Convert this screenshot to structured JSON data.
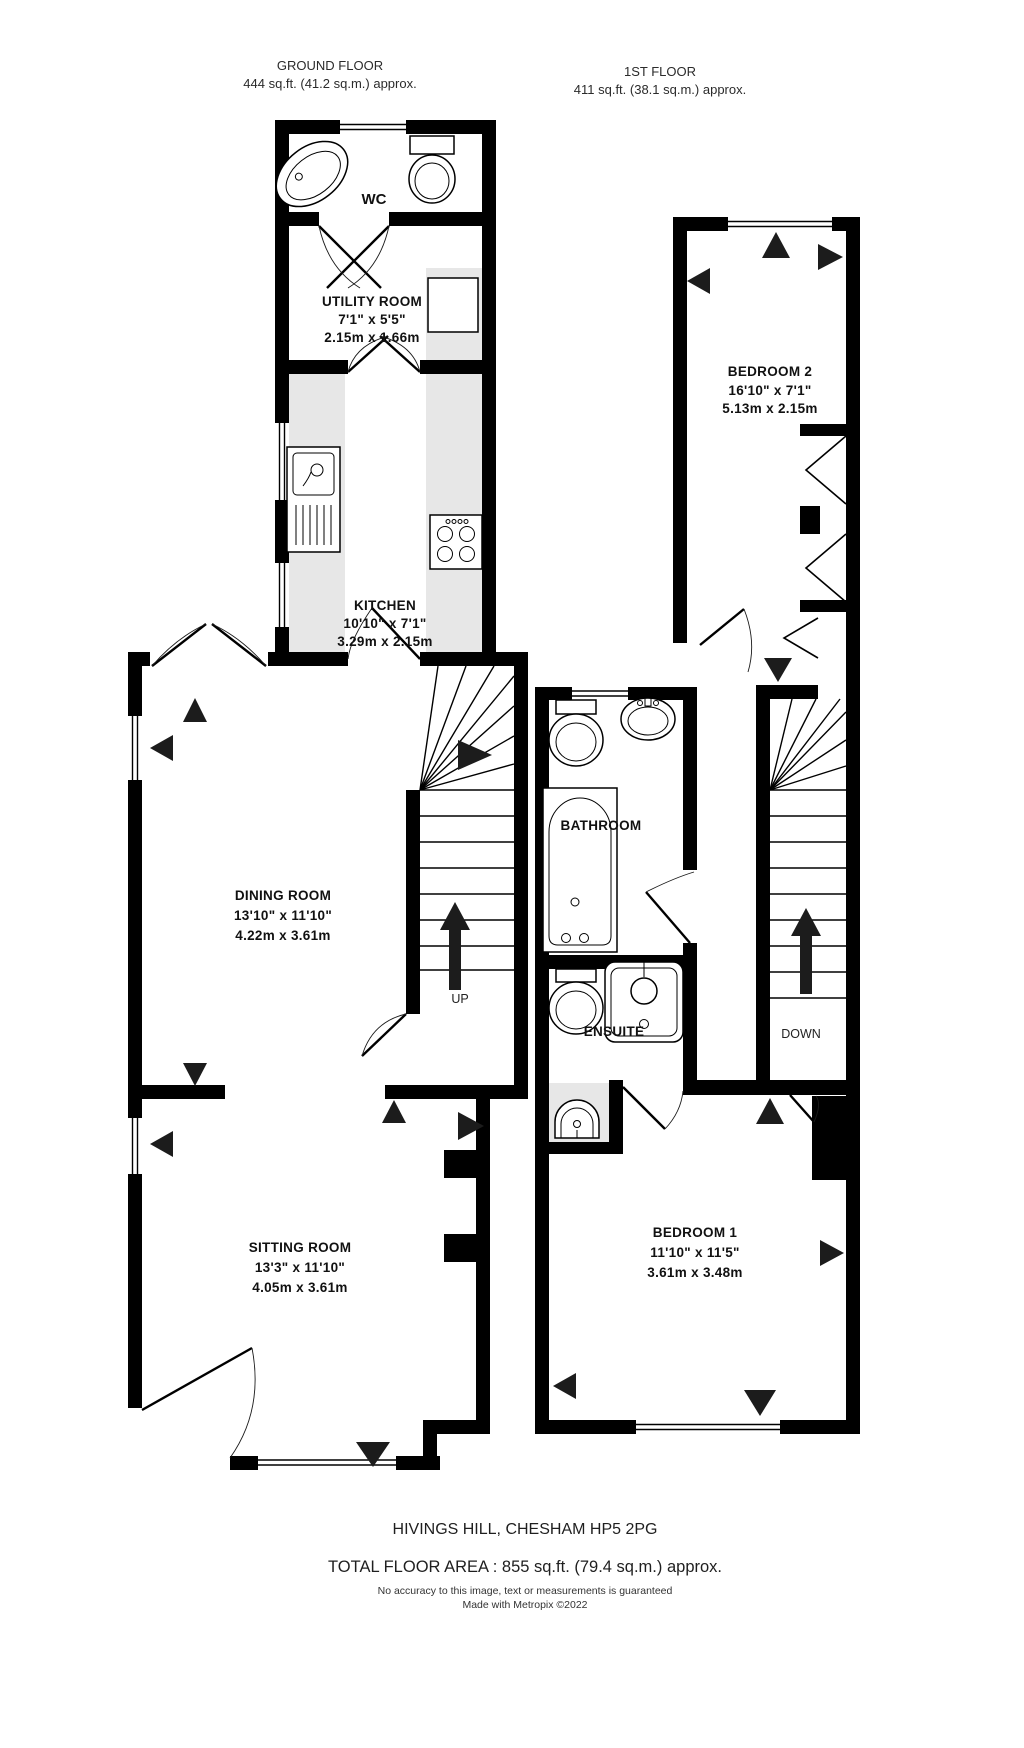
{
  "floors": {
    "ground": {
      "title": "GROUND FLOOR",
      "area": "444 sq.ft. (41.2 sq.m.) approx."
    },
    "first": {
      "title": "1ST FLOOR",
      "area": "411 sq.ft. (38.1 sq.m.) approx."
    }
  },
  "rooms": {
    "wc": {
      "name": "WC"
    },
    "utility": {
      "name": "UTILITY ROOM",
      "size_imperial": "7'1\" x 5'5\"",
      "size_metric": "2.15m x 1.66m"
    },
    "kitchen": {
      "name": "KITCHEN",
      "size_imperial": "10'10\" x 7'1\"",
      "size_metric": "3.29m x 2.15m"
    },
    "dining": {
      "name": "DINING ROOM",
      "size_imperial": "13'10\" x 11'10\"",
      "size_metric": "4.22m x 3.61m"
    },
    "sitting": {
      "name": "SITTING ROOM",
      "size_imperial": "13'3\" x 11'10\"",
      "size_metric": "4.05m x 3.61m"
    },
    "bedroom2": {
      "name": "BEDROOM 2",
      "size_imperial": "16'10\" x 7'1\"",
      "size_metric": "5.13m x 2.15m"
    },
    "bathroom": {
      "name": "BATHROOM"
    },
    "ensuite": {
      "name": "ENSUITE"
    },
    "bedroom1": {
      "name": "BEDROOM 1",
      "size_imperial": "11'10\" x 11'5\"",
      "size_metric": "3.61m x 3.48m"
    }
  },
  "stairs": {
    "up": "UP",
    "down": "DOWN"
  },
  "footer": {
    "address": "HIVINGS HILL, CHESHAM HP5 2PG",
    "total_area": "TOTAL FLOOR AREA : 855 sq.ft. (79.4 sq.m.) approx.",
    "disclaimer": "No accuracy to this image, text or measurements is guaranteed",
    "credit": "Made with Metropix ©2022"
  },
  "colors": {
    "wall": "#000000",
    "counter": "#e7e7e7",
    "background": "#ffffff"
  }
}
